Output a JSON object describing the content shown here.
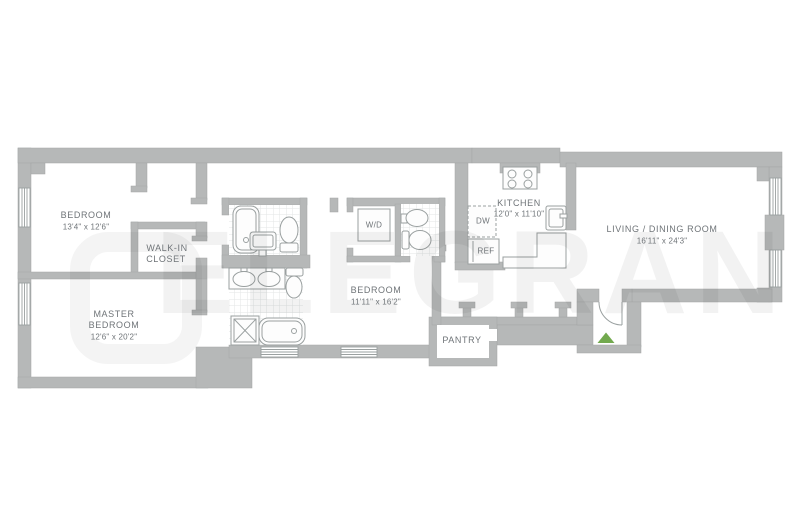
{
  "floorplan": {
    "watermark": "ELEGRAN",
    "labels": {
      "bedroom1_name": "BEDROOM",
      "bedroom1_dims": "13'4\" x 12'6\"",
      "walkin_line1": "WALK-IN",
      "walkin_line2": "CLOSET",
      "master_line1": "MASTER",
      "master_line2": "BEDROOM",
      "master_dims": "12'6\" x 20'2\"",
      "bedroom2_name": "BEDROOM",
      "bedroom2_dims": "11'11\" x 16'2\"",
      "kitchen_name": "KITCHEN",
      "kitchen_dims": "12'0\" x 11'10\"",
      "living_name": "LIVING / DINING ROOM",
      "living_dims": "16'11\" x 24'3\"",
      "pantry": "PANTRY",
      "washer_dryer": "W/D",
      "dishwasher": "DW",
      "refrigerator": "REF"
    },
    "colors": {
      "wall": "#b6b8b8",
      "fixture_line": "#9aa0a0",
      "label_text": "#6f7478",
      "tile_line": "#e3e5e5",
      "entry_marker": "#72a94e"
    }
  }
}
